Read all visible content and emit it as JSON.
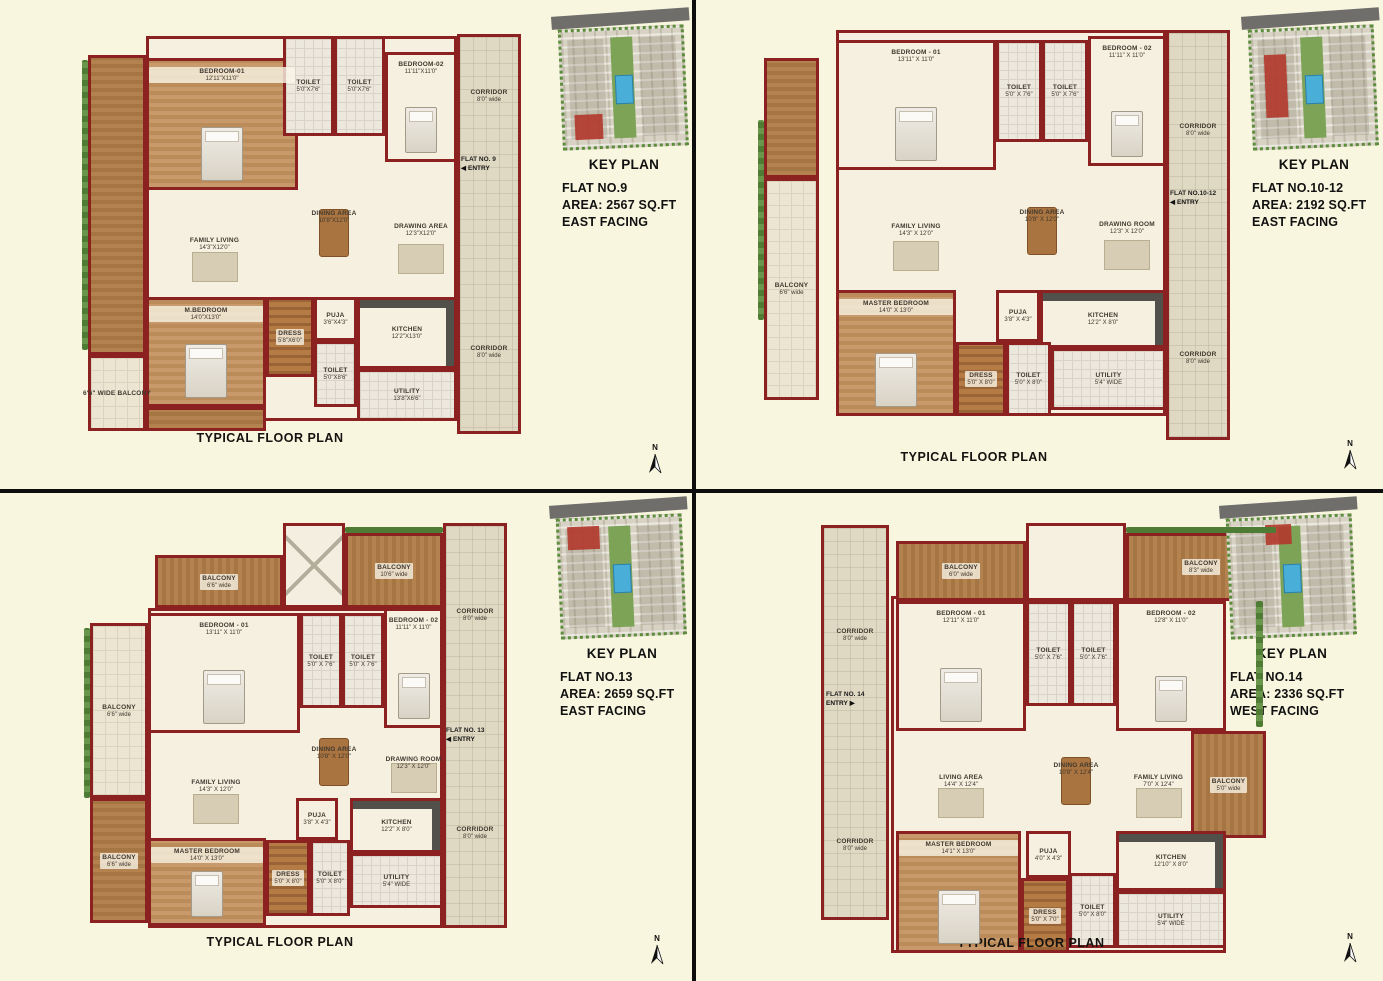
{
  "page": {
    "caption": "TYPICAL FLOOR PLAN",
    "north_label": "N",
    "wall_color": "#8c2121",
    "background_color": "#f9f6df",
    "highlight_color": "#b23a2e"
  },
  "panels": [
    {
      "flat": "FLAT NO.9",
      "area": "AREA: 2567 SQ.FT",
      "facing": "EAST FACING",
      "key_plan_title": "KEY PLAN",
      "entry": {
        "flat": "FLAT NO. 9",
        "label": "ENTRY",
        "arrow": "◀"
      },
      "corridor_top": {
        "name": "CORRIDOR",
        "dim": "8'0\" wide"
      },
      "corridor_bottom": {
        "name": "CORRIDOR",
        "dim": "8'0\" wide"
      },
      "rooms": {
        "bedroom1": {
          "name": "BEDROOM-01",
          "dim": "12'11\"X11'0\""
        },
        "toilet1": {
          "name": "TOILET",
          "dim": "5'0\"X7'6\""
        },
        "toilet2": {
          "name": "TOILET",
          "dim": "5'0\"X7'6\""
        },
        "bedroom2": {
          "name": "BEDROOM-02",
          "dim": "11'11\"X11'0\""
        },
        "family": {
          "name": "FAMILY LIVING",
          "dim": "14'3\"X12'0\""
        },
        "dining": {
          "name": "DINING AREA",
          "dim": "10'8\"X12'0\""
        },
        "drawing": {
          "name": "DRAWING AREA",
          "dim": "12'3\"X12'0\""
        },
        "master": {
          "name": "M.BEDROOM",
          "dim": "14'0\"X13'0\""
        },
        "dress": {
          "name": "DRESS",
          "dim": "5'8\"X6'0\""
        },
        "puja": {
          "name": "PUJA",
          "dim": "3'6\"X4'3\""
        },
        "kitchen": {
          "name": "KITCHEN",
          "dim": "12'2\"X13'0\""
        },
        "toilet3": {
          "name": "TOILET",
          "dim": "5'0\"X8'6\""
        },
        "utility": {
          "name": "UTILITY",
          "dim": "13'8\"X6'6\""
        },
        "balcony_main": {
          "name": "6'6\" WIDE BALCONY",
          "dim": ""
        }
      }
    },
    {
      "flat": "FLAT NO.10-12",
      "area": "AREA: 2192 SQ.FT",
      "facing": "EAST FACING",
      "key_plan_title": "KEY PLAN",
      "entry": {
        "flat": "FLAT NO.10-12",
        "label": "ENTRY",
        "arrow": "◀"
      },
      "corridor_top": {
        "name": "CORRIDOR",
        "dim": "8'0\" wide"
      },
      "corridor_bottom": {
        "name": "CORRIDOR",
        "dim": "8'0\" wide"
      },
      "rooms": {
        "bedroom1": {
          "name": "BEDROOM - 01",
          "dim": "13'11\" X 11'0\""
        },
        "toilet1": {
          "name": "TOILET",
          "dim": "5'0\" X 7'6\""
        },
        "toilet2": {
          "name": "TOILET",
          "dim": "5'0\" X 7'6\""
        },
        "bedroom2": {
          "name": "BEDROOM - 02",
          "dim": "11'11\" X 11'0\""
        },
        "family": {
          "name": "FAMILY LIVING",
          "dim": "14'3\" X 12'0\""
        },
        "dining": {
          "name": "DINING AREA",
          "dim": "10'8\" X 12'0\""
        },
        "drawing": {
          "name": "DRAWING ROOM",
          "dim": "12'3\" X 12'0\""
        },
        "master": {
          "name": "MASTER BEDROOM",
          "dim": "14'0\" X 13'0\""
        },
        "balcony_left": {
          "name": "BALCONY",
          "dim": "6'6\" wide"
        },
        "puja": {
          "name": "PUJA",
          "dim": "3'8\" X 4'3\""
        },
        "kitchen": {
          "name": "KITCHEN",
          "dim": "12'2\" X 8'0\""
        },
        "dress": {
          "name": "DRESS",
          "dim": "5'0\" X 8'0\""
        },
        "toilet3": {
          "name": "TOILET",
          "dim": "5'0\" X 8'0\""
        },
        "utility": {
          "name": "UTILITY",
          "dim": "5'4\" WIDE"
        }
      }
    },
    {
      "flat": "FLAT NO.13",
      "area": "AREA: 2659 SQ.FT",
      "facing": "EAST FACING",
      "key_plan_title": "KEY PLAN",
      "entry": {
        "flat": "FLAT NO. 13",
        "label": "ENTRY",
        "arrow": "◀"
      },
      "corridor_top": {
        "name": "CORRIDOR",
        "dim": "8'0\" wide"
      },
      "corridor_bottom": {
        "name": "CORRIDOR",
        "dim": "8'0\" wide"
      },
      "rooms": {
        "balcony_top1": {
          "name": "BALCONY",
          "dim": "6'6\" wide"
        },
        "balcony_top2": {
          "name": "BALCONY",
          "dim": "10'6\" wide"
        },
        "balcony_left": {
          "name": "BALCONY",
          "dim": "6'6\" wide"
        },
        "balcony_left2": {
          "name": "BALCONY",
          "dim": "6'6\" wide"
        },
        "bedroom1": {
          "name": "BEDROOM - 01",
          "dim": "13'11\" X 11'0\""
        },
        "toilet1": {
          "name": "TOILET",
          "dim": "5'0\" X 7'6\""
        },
        "toilet2": {
          "name": "TOILET",
          "dim": "5'0\" X 7'6\""
        },
        "bedroom2": {
          "name": "BEDROOM - 02",
          "dim": "11'11\" X 11'0\""
        },
        "family": {
          "name": "FAMILY LIVING",
          "dim": "14'3\" X 12'0\""
        },
        "dining": {
          "name": "DINING AREA",
          "dim": "10'8\" X 12'0\""
        },
        "drawing": {
          "name": "DRAWING ROOM",
          "dim": "12'3\" X 12'0\""
        },
        "master": {
          "name": "MASTER BEDROOM",
          "dim": "14'0\" X 13'0\""
        },
        "puja": {
          "name": "PUJA",
          "dim": "3'8\" X 4'3\""
        },
        "kitchen": {
          "name": "KITCHEN",
          "dim": "12'2\" X 8'0\""
        },
        "dress": {
          "name": "DRESS",
          "dim": "5'0\" X 8'0\""
        },
        "toilet3": {
          "name": "TOILET",
          "dim": "5'0\" X 8'0\""
        },
        "utility": {
          "name": "UTILITY",
          "dim": "5'4\" WIDE"
        }
      }
    },
    {
      "flat": "FLAT NO.14",
      "area": "AREA: 2336 SQ.FT",
      "facing": "WEST FACING",
      "key_plan_title": "KEY PLAN",
      "entry": {
        "flat": "FLAT NO. 14",
        "label": "ENTRY",
        "arrow": "▶"
      },
      "corridor_top": {
        "name": "CORRIDOR",
        "dim": "8'0\" wide"
      },
      "corridor_bottom": {
        "name": "CORRIDOR",
        "dim": "8'0\" wide"
      },
      "rooms": {
        "balcony_top1": {
          "name": "BALCONY",
          "dim": "6'0\" wide"
        },
        "balcony_top2": {
          "name": "BALCONY",
          "dim": "8'3\" wide"
        },
        "bedroom1": {
          "name": "BEDROOM - 01",
          "dim": "12'11\" X 11'0\""
        },
        "toilet1": {
          "name": "TOILET",
          "dim": "5'0\" X 7'6\""
        },
        "toilet2": {
          "name": "TOILET",
          "dim": "5'0\" X 7'6\""
        },
        "bedroom2": {
          "name": "BEDROOM - 02",
          "dim": "12'8\" X 11'0\""
        },
        "living": {
          "name": "LIVING AREA",
          "dim": "14'4\" X 12'4\""
        },
        "dining": {
          "name": "DINING AREA",
          "dim": "10'8\" X 12'4\""
        },
        "family": {
          "name": "FAMILY LIVING",
          "dim": "7'0\" X 12'4\""
        },
        "balcony_right": {
          "name": "BALCONY",
          "dim": "5'0\" wide"
        },
        "master": {
          "name": "MASTER BEDROOM",
          "dim": "14'1\" X 13'0\""
        },
        "puja": {
          "name": "PUJA",
          "dim": "4'0\" X 4'3\""
        },
        "kitchen": {
          "name": "KITCHEN",
          "dim": "12'10\" X 8'0\""
        },
        "dress": {
          "name": "DRESS",
          "dim": "5'0\" X 7'0\""
        },
        "toilet3": {
          "name": "TOILET",
          "dim": "5'0\" X 8'0\""
        },
        "utility": {
          "name": "UTILITY",
          "dim": "5'4\" WIDE"
        }
      }
    }
  ]
}
